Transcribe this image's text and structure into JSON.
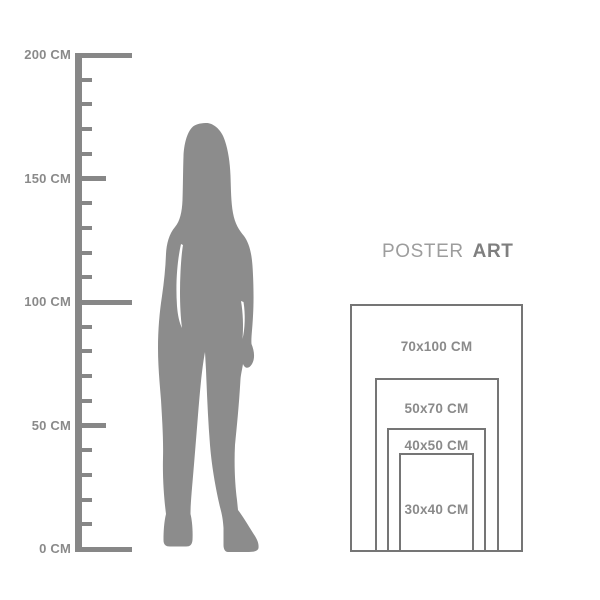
{
  "background": "#ffffff",
  "colors": {
    "figure": "#8c8c8c",
    "ruler": "#878787",
    "ruler_label": "#8a8a8a",
    "poster_border": "#757575",
    "poster_label": "#8a8a8a",
    "title_regular": "#9d9d9d",
    "title_bold": "#7f7f7f"
  },
  "title": {
    "regular": "POSTER",
    "bold": "ART"
  },
  "ruler": {
    "unit": "CM",
    "min_cm": 0,
    "max_cm": 200,
    "tick_step_cm": 10,
    "labels": [
      {
        "value": 200,
        "text": "200 CM"
      },
      {
        "value": 150,
        "text": "150 CM"
      },
      {
        "value": 100,
        "text": "100 CM"
      },
      {
        "value": 50,
        "text": "50 CM"
      },
      {
        "value": 0,
        "text": "0 CM"
      }
    ]
  },
  "figure": {
    "description": "gray silhouette of a standing woman with long hair and ankle boots"
  },
  "poster_sizes": [
    {
      "label": "70x100 CM",
      "width_cm": 70,
      "height_cm": 100
    },
    {
      "label": "50x70 CM",
      "width_cm": 50,
      "height_cm": 70
    },
    {
      "label": "40x50 CM",
      "width_cm": 40,
      "height_cm": 50
    },
    {
      "label": "30x40 CM",
      "width_cm": 30,
      "height_cm": 40
    }
  ]
}
